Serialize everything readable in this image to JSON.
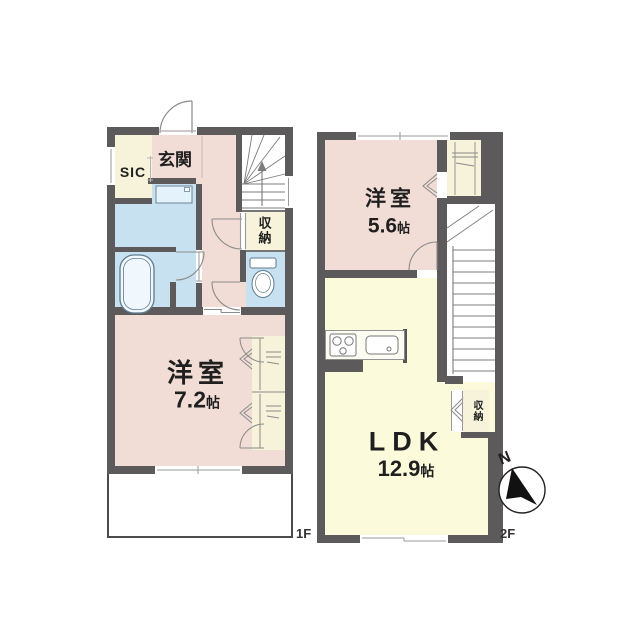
{
  "title": "2-story apartment floor plan",
  "floor1": {
    "label": "1F",
    "rooms": {
      "sic": "SIC",
      "genkan": "玄関",
      "storage": "収納",
      "bedroom": {
        "name": "洋室",
        "size_value": "7.2",
        "size_unit": "帖"
      }
    }
  },
  "floor2": {
    "label": "2F",
    "rooms": {
      "bedroom": {
        "name": "洋室",
        "size_value": "5.6",
        "size_unit": "帖"
      },
      "ldk": {
        "name": "LDK",
        "size_value": "12.9",
        "size_unit": "帖"
      },
      "storage": "収納"
    }
  },
  "compass": {
    "north": "N"
  },
  "colors": {
    "wall": "#5c5a5b",
    "room_pink": "#f2ddd6",
    "room_yellow": "#fbfadb",
    "room_blue": "#c8e1f0",
    "room_cream": "#f7f3da",
    "fixture_stroke": "#5d7b8d"
  }
}
